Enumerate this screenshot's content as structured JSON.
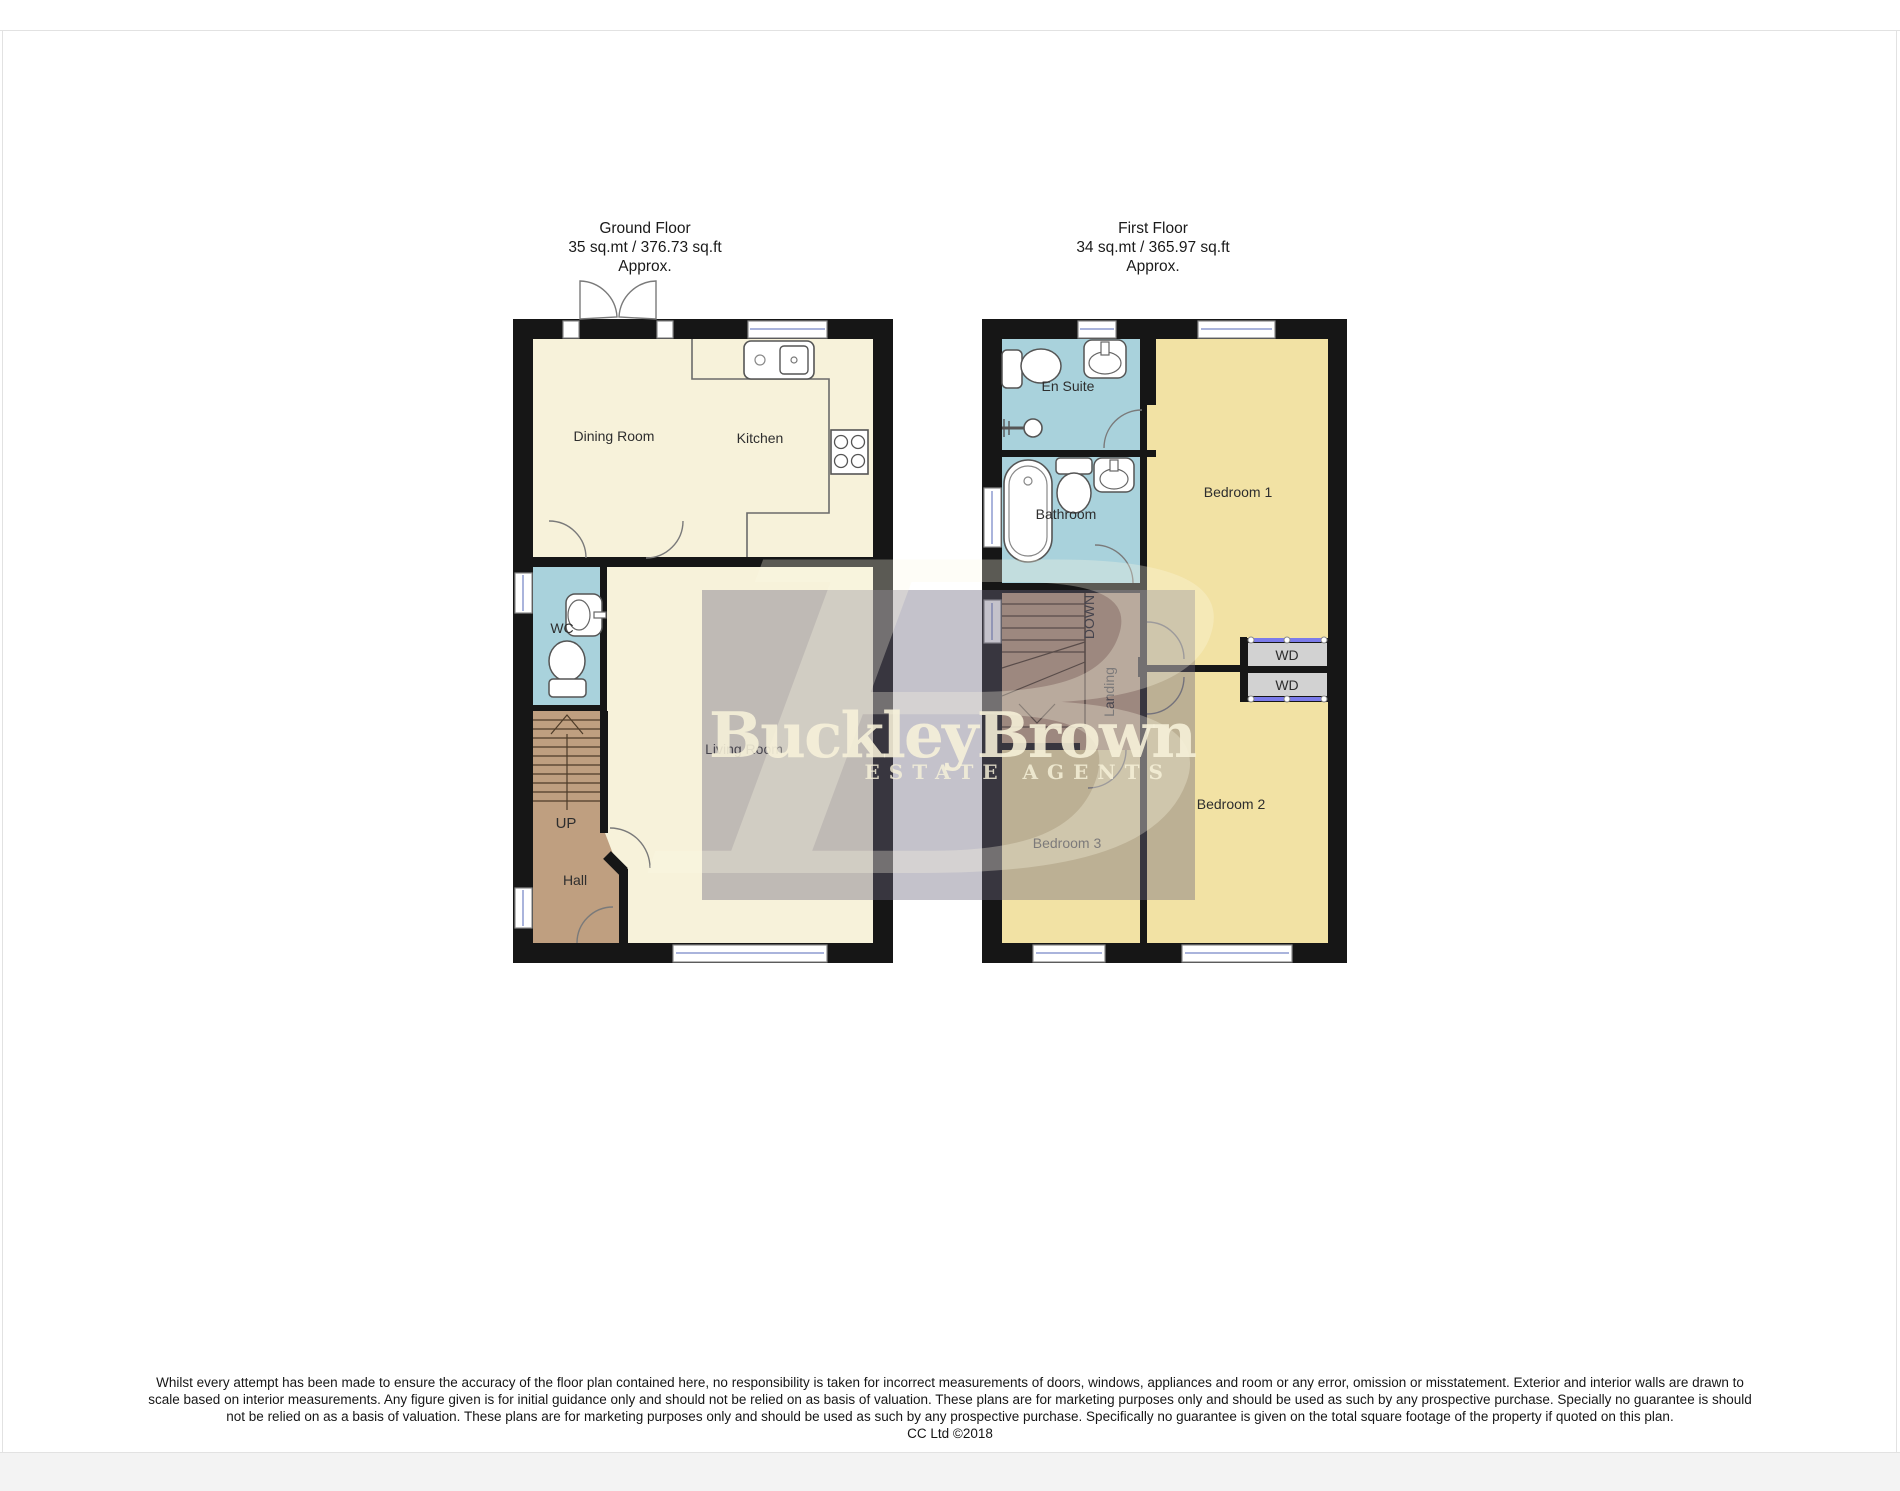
{
  "ground_floor": {
    "title": "Ground Floor",
    "area_line": "35 sq.mt / 376.73 sq.ft",
    "approx_line": "Approx.",
    "rooms": {
      "dining_room": "Dining Room",
      "kitchen": "Kitchen",
      "wc": "WC",
      "living_room": "Living Room",
      "hall": "Hall",
      "stairs_direction": "UP"
    }
  },
  "first_floor": {
    "title": "First Floor",
    "area_line": "34 sq.mt / 365.97 sq.ft",
    "approx_line": "Approx.",
    "rooms": {
      "en_suite": "En Suite",
      "bathroom": "Bathroom",
      "bedroom_1": "Bedroom 1",
      "bedroom_2": "Bedroom 2",
      "bedroom_3": "Bedroom 3",
      "landing": "Landing",
      "stairs_direction": "DOWN",
      "wardrobe_1": "WD",
      "wardrobe_2": "WD"
    }
  },
  "watermark": {
    "brand": "BuckleyBrown",
    "tagline": "ESTATE AGENTS",
    "monogram": "B"
  },
  "disclaimer": {
    "line1": "Whilst every attempt has been made to ensure the accuracy of the floor plan contained here, no responsibility is taken for incorrect measurements of doors, windows, appliances and room or any error, omission or misstatement. Exterior and interior walls are drawn to",
    "line2": "scale based on interior measurements. Any figure given is for initial guidance only and should not be relied on as basis of valuation. These plans are for marketing purposes only and should be used as such by any prospective purchase. Specially no guarantee is should",
    "line3": "not be relied on as a basis of valuation. These plans are for marketing purposes only and should be used as such by any prospective purchase. Specifically no guarantee is given on the total square footage of the property if quoted on this plan.",
    "copyright": "CC Ltd ©2018"
  },
  "colors": {
    "wall": "#161616",
    "ground_floor_surface": "#f7f2da",
    "bedroom_surface": "#f2e2a4",
    "wet_room_surface": "#a9d2dc",
    "wood_surface": "#bf9f80",
    "watermark_text": "#f7f1d9",
    "watermark_box": "#6c677e",
    "window_glass": "#aab4dc",
    "wardrobe_fill": "#d2d2d2",
    "sliding_door": "#7b7bea"
  }
}
